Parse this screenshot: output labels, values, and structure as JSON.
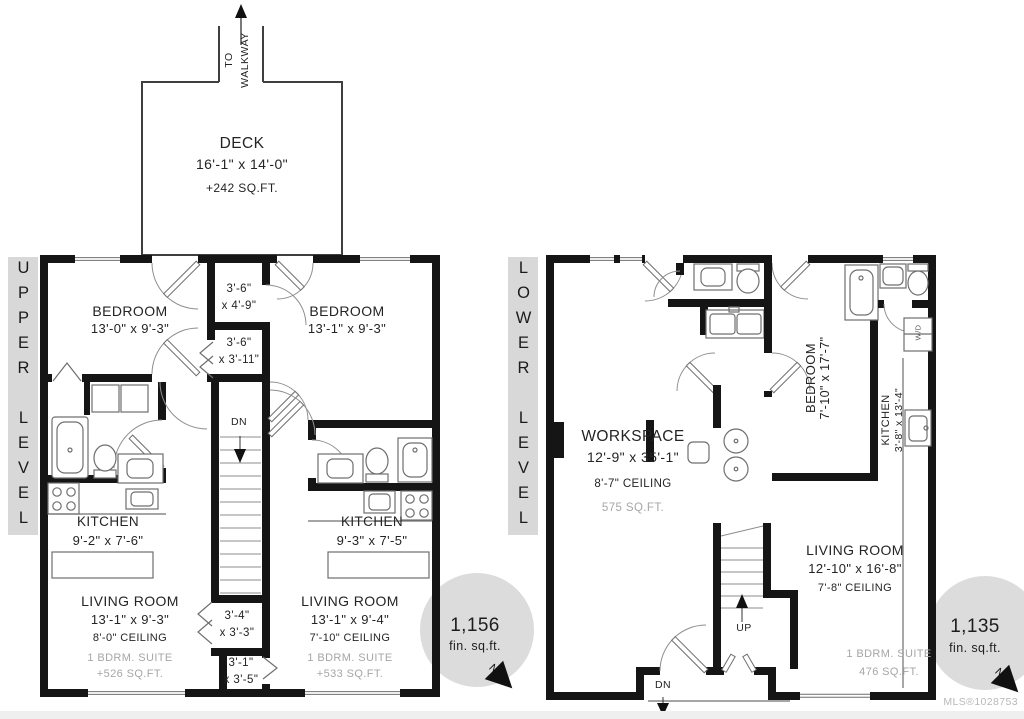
{
  "upper": {
    "level_label": "UPPER LEVEL",
    "deck": {
      "name": "DECK",
      "dims": "16'-1\" x 14'-0\"",
      "area": "+242 SQ.FT.",
      "walkway": "TO\nWALKWAY"
    },
    "bedroom_left": {
      "name": "BEDROOM",
      "dims": "13'-0\" x 9'-3\""
    },
    "bedroom_right": {
      "name": "BEDROOM",
      "dims": "13'-1\" x 9'-3\""
    },
    "closet_top": "3'-6\"\nx 4'-9\"",
    "closet_mid": "3'-6\"\nx 3'-11\"",
    "closet_bottom_left": "3'-4\"\nx 3'-3\"",
    "closet_bottom_right": "3'-1\"\nx 3'-5\"",
    "stairs_down_label": "DN",
    "kitchen_left": {
      "name": "KITCHEN",
      "dims": "9'-2\" x 7'-6\""
    },
    "kitchen_right": {
      "name": "KITCHEN",
      "dims": "9'-3\" x 7'-5\""
    },
    "living_left": {
      "name": "LIVING ROOM",
      "dims": "13'-1\" x 9'-3\"",
      "ceiling": "8'-0\" CEILING",
      "suite": "1 BDRM. SUITE",
      "suite_area": "+526 SQ.FT."
    },
    "living_right": {
      "name": "LIVING ROOM",
      "dims": "13'-1\" x 9'-4\"",
      "ceiling": "7'-10\" CEILING",
      "suite": "1 BDRM. SUITE",
      "suite_area": "+533 SQ.FT."
    },
    "compass": {
      "area": "1,156",
      "unit": "fin. sq.ft.",
      "north": "N"
    }
  },
  "lower": {
    "level_label": "LOWER LEVEL",
    "workspace": {
      "name": "WORKSPACE",
      "dims": "12'-9\" x 35'-1\"",
      "ceiling": "8'-7\" CEILING",
      "area": "575 SQ.FT."
    },
    "bedroom": {
      "name": "BEDROOM",
      "dims": "7'-10\" x 17'-7\""
    },
    "kitchen": {
      "name": "KITCHEN",
      "dims": "3'-8\" x 13'-4\""
    },
    "living": {
      "name": "LIVING ROOM",
      "dims": "12'-10\" x 16'-8\"",
      "ceiling": "7'-8\" CEILING",
      "suite": "1 BDRM. SUITE",
      "suite_area": "476 SQ.FT."
    },
    "stairs_up_label": "UP",
    "stairs_down_label": "DN",
    "washer_dryer": "W/D",
    "compass": {
      "area": "1,135",
      "unit": "fin. sq.ft.",
      "north": "N"
    }
  },
  "footer": {
    "mls": "MLS®1028753"
  },
  "colors": {
    "wall": "#151515",
    "thin_line": "#6f6f6f",
    "level_strip": "#d8d8d8",
    "compass_circle": "#dcdcdc",
    "muted_text": "#a6a6a6"
  }
}
